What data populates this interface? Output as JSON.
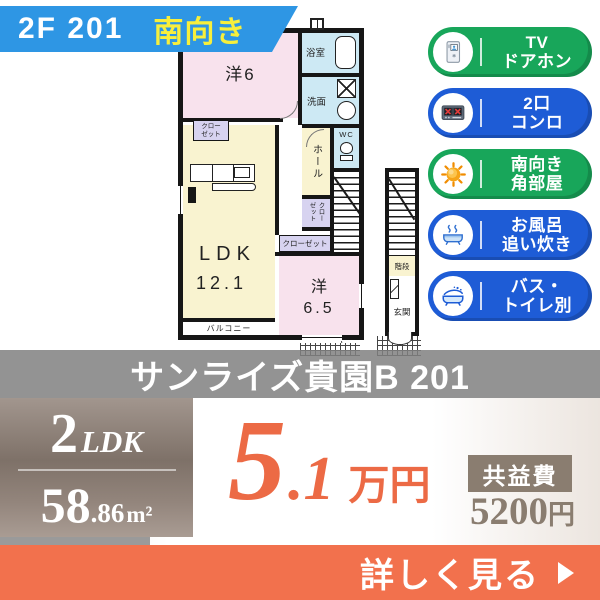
{
  "banner": {
    "unit": "2F  201",
    "direction": "南向き"
  },
  "plan": {
    "yo6": "洋6",
    "bath": "浴室",
    "wash": "洗面",
    "wc": "WC",
    "hall": "ホール",
    "closet_upper_l1": "クロー",
    "closet_upper_l2": "ゼット",
    "closet_small": "クローゼット",
    "closet_lower": "クローゼット",
    "ldk": "LDK",
    "ldk_size": "12.1",
    "yo65": "洋",
    "yo65_size": "6.5",
    "balcony": "バルコニー",
    "stairs": "階段",
    "entrance": "玄関"
  },
  "features": [
    {
      "line1": "TV",
      "line2": "ドアホン",
      "color": "#18a65a",
      "icon": "doorphone-icon"
    },
    {
      "line1": "2口",
      "line2": "コンロ",
      "color": "#1e5cd6",
      "icon": "stove-icon"
    },
    {
      "line1": "南向き",
      "line2": "角部屋",
      "color": "#18a65a",
      "icon": "sun-icon"
    },
    {
      "line1": "お風呂",
      "line2": "追い炊き",
      "color": "#1e5cd6",
      "icon": "bath-reheat-icon"
    },
    {
      "line1": "バス・",
      "line2": "トイレ別",
      "color": "#1e5cd6",
      "icon": "bath-splash-icon"
    }
  ],
  "property": {
    "name": "サンライズ貴園B 201"
  },
  "summary": {
    "layout_count": "2",
    "layout_type": "LDK",
    "area_main": "58",
    "area_dec": ".86",
    "area_unit": "m²",
    "price_main": "5",
    "price_dec": ".1",
    "price_unit": "万円",
    "fee_label": "共益費",
    "fee_amount": "5200",
    "fee_unit": "円"
  },
  "cta": {
    "label": "詳しく見る",
    "arrow_icon": "play-arrow-right"
  },
  "colors": {
    "banner_bg": "#2e96e4",
    "banner_direction": "#f7ef3c",
    "badge_green": "#18a65a",
    "badge_blue": "#1e5cd6",
    "band_bg": "rgba(128,128,128,0.85)",
    "spec_box_bg": "linear-gradient(180deg,#a2968e,#7e7168 45%,#93857c 75%,#a99c93)",
    "price": "#ec6a45",
    "fee": "#8a7d70",
    "cta_bg": "#f2714d"
  }
}
